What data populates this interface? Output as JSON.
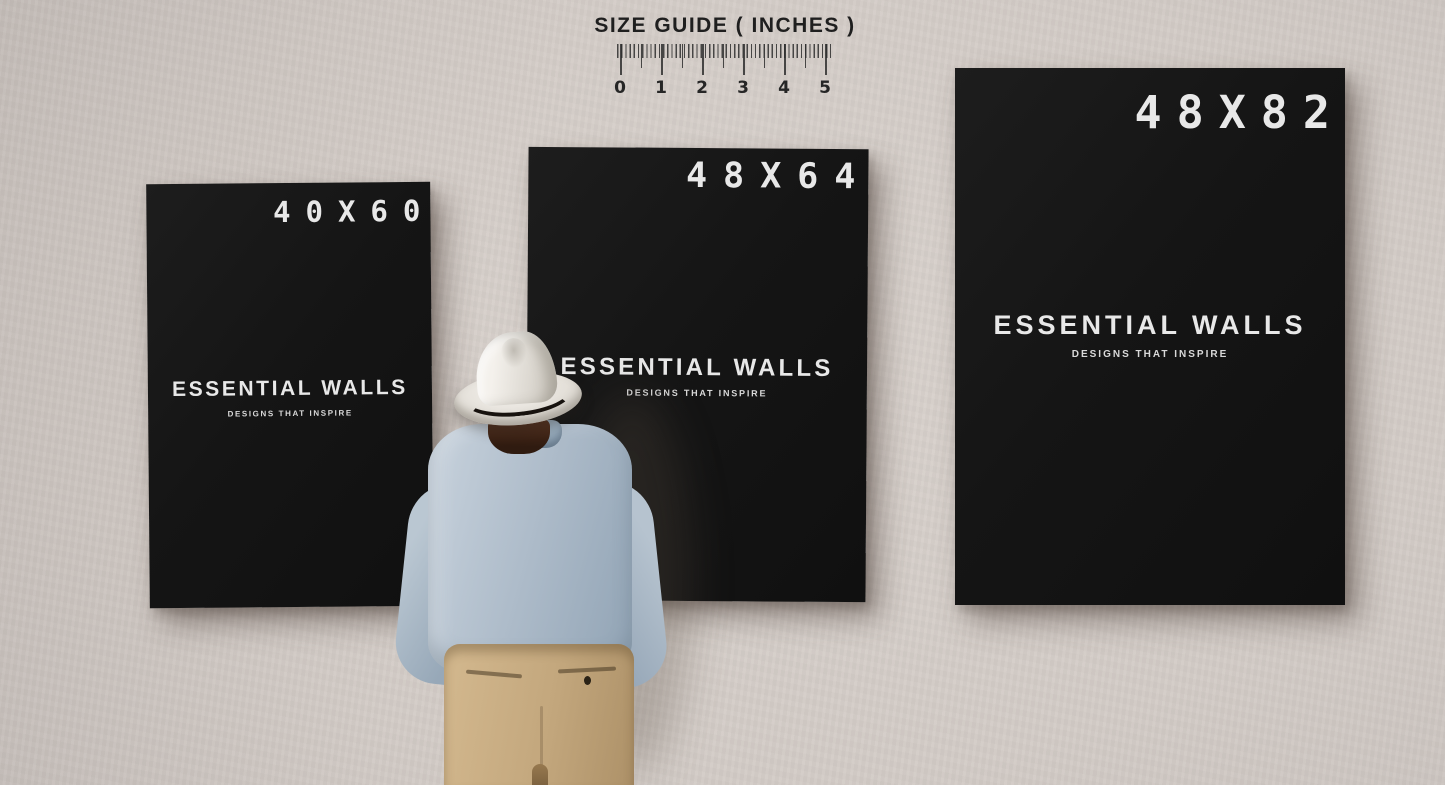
{
  "size_guide": {
    "title": "SIZE GUIDE ( INCHES )",
    "tick_labels": [
      "0",
      "1",
      "2",
      "3",
      "4",
      "5"
    ]
  },
  "posters": [
    {
      "size_label": "40X60",
      "brand": "ESSENTIAL WALLS",
      "tagline": "DESIGNS THAT INSPIRE"
    },
    {
      "size_label": "48X64",
      "brand": "ESSENTIAL WALLS",
      "tagline": "DESIGNS THAT INSPIRE"
    },
    {
      "size_label": "48X82",
      "brand": "ESSENTIAL WALLS",
      "tagline": "DESIGNS THAT INSPIRE"
    }
  ],
  "figure": {
    "hat": "white-fedora-hat",
    "shirt": "light-blue-shirt",
    "pants": "khaki-pants"
  },
  "colors": {
    "wall": "#d3ccc7",
    "poster_bg": "#141414",
    "poster_text": "#e8e8e8",
    "ruler_ink": "#2e2e2e",
    "hat": "#ebe8e2",
    "hat_band": "#17120e",
    "shirt": "#a9b9c6",
    "pants": "#c3a77d",
    "hair": "#3c2416"
  }
}
